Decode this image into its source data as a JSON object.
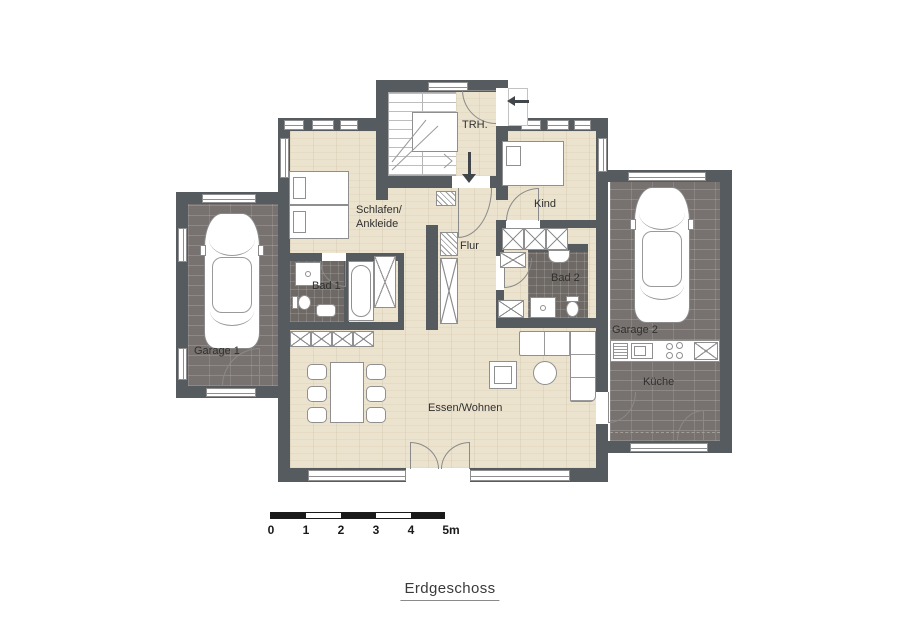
{
  "title": "Erdgeschoss",
  "rooms": {
    "trh": "TRH.",
    "schlafen_line1": "Schlafen/",
    "schlafen_line2": "Ankleide",
    "kind": "Kind",
    "flur": "Flur",
    "bad1": "Bad 1",
    "bad2": "Bad 2",
    "garage1": "Garage 1",
    "garage2": "Garage 2",
    "kueche": "Küche",
    "wohnen": "Essen/Wohnen"
  },
  "scale_bar": {
    "ticks": [
      "0",
      "1",
      "2",
      "3",
      "4",
      "5m"
    ]
  },
  "icons": {
    "entry_arrow": "arrow-left-icon",
    "hall_arrow": "arrow-down-icon"
  },
  "colors": {
    "wall": "#565b5f",
    "wood_floor": "#ece3cf",
    "dark_floor": "#77726f",
    "bath_floor": "#6e6965",
    "furniture_line": "#8f8f8f",
    "scale_bar": "#1a1a1a",
    "arrow": "#41464a"
  }
}
